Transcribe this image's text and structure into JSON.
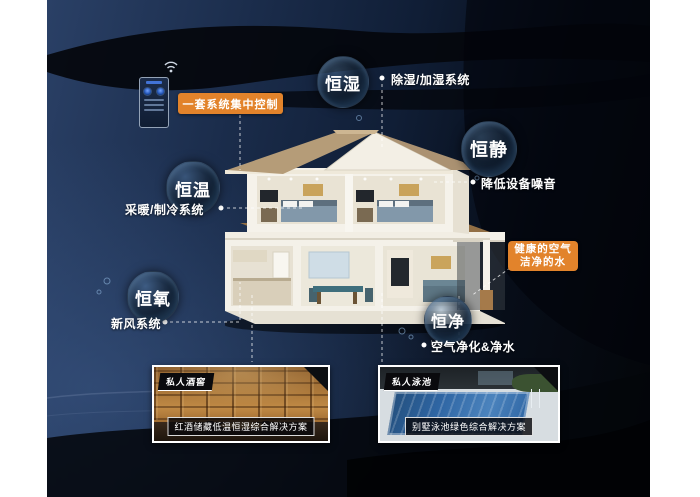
{
  "meta": {
    "description": "Smart villa constant-climate system infographic with cutaway house",
    "colors": {
      "accent_orange": "#e2832b",
      "background_navy": "#1b2d4c",
      "background_black": "#04070c",
      "bubble_rim_blue": "#6a9ac4",
      "text_white": "#ffffff"
    }
  },
  "control_panel": {
    "label": "一套系统集中控制",
    "device": "wall-mounted smart controller",
    "icons": [
      "wifi-icon"
    ]
  },
  "bubbles": [
    {
      "label": "恒湿",
      "annotation": "除湿/加湿系统"
    },
    {
      "label": "恒静",
      "annotation": "降低设备噪音"
    },
    {
      "label": "恒温",
      "annotation": "采暖/制冷系统"
    },
    {
      "label": "恒氧",
      "annotation": "新风系统"
    },
    {
      "label": "恒净",
      "annotation": "空气净化&净水"
    }
  ],
  "callout": {
    "line1": "健康的空气",
    "line2": "洁净的水"
  },
  "cards": [
    {
      "tag": "私人酒窖",
      "caption": "红酒储藏低温恒湿综合解决方案"
    },
    {
      "tag": "私人泳池",
      "caption": "别墅泳池绿色综合解决方案"
    }
  ]
}
